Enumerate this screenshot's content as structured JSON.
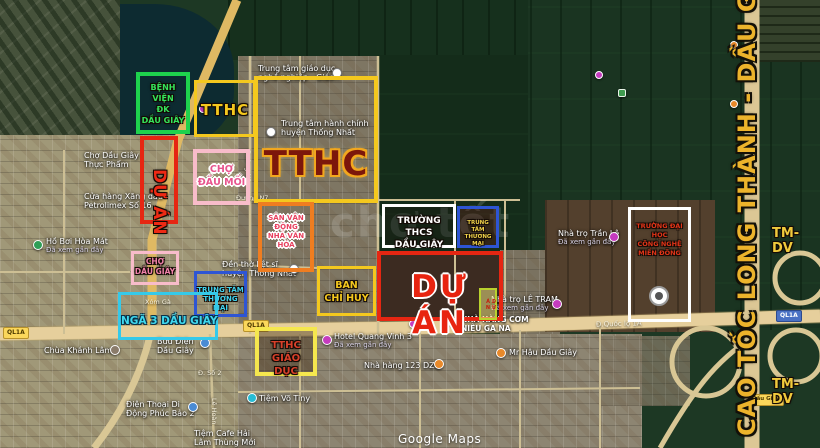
{
  "map": {
    "watermark": "chợ tốt",
    "attribution": "Google Maps"
  },
  "colors": {
    "yellow_box": "#f4c81e",
    "red_box": "#e62612",
    "green_box": "#1ed24d",
    "pink_box": "#f8bcca",
    "blue_box": "#2e55d4",
    "cyan_box": "#35c9e9",
    "orange_box": "#ef7d20",
    "white_box": "#ffffff",
    "lime_box": "#cde23e",
    "gold_text": "#ecb32b"
  },
  "annotations": {
    "benh_vien": {
      "line1": "BỆNH VIỆN",
      "line2": "ĐK",
      "line3": "DẦU GIÂY"
    },
    "tthc_small": {
      "label": "TTHC"
    },
    "tthc_big": {
      "label": "TTHC"
    },
    "du_an_left": {
      "label": "DỰ ÁN"
    },
    "cho_dau_moi": {
      "line1": "CHỢ",
      "line2": "ĐẦU MỐI"
    },
    "san_van_dong": {
      "line1": "SÂN VẬN ĐỘNG",
      "line2": "NHÀ VĂN HÓA"
    },
    "truong_thcs": {
      "line1": "TRƯỜNG THCS",
      "line2": "DẦU GIÂY"
    },
    "ttm_right": {
      "line1": "TRUNG TÂM",
      "line2": "THƯƠNG MẠI"
    },
    "du_an_big": {
      "label": "DỰ ÁN"
    },
    "ban_chi_huy": {
      "line1": "BAN",
      "line2": "CHỈ HUY"
    },
    "du_an_mini": {
      "label": "DỰ ÁN"
    },
    "cho_dau_giay": {
      "line1": "CHỢ",
      "line2": "DẦU GIÂY"
    },
    "ttm_left": {
      "line1": "TRUNG TÂM",
      "line2": "THƯƠNG MẠI"
    },
    "nga_3": {
      "label": "NGÃ 3 DẦU GIÂY"
    },
    "tthc_giao_duc": {
      "line1": "TTHC",
      "line2": "GIÁO DỤC"
    },
    "truong_dai_hoc": {
      "line1": "TRƯỜNG ĐẠI HỌC",
      "line2": "CÔNG NGHỆ",
      "line3": "MIỀN ĐÔNG"
    },
    "cao_toc": {
      "label": "CAO TỐC LONG THÀNH - DẦU GIÂY"
    },
    "tm_dv": {
      "label": "TM-DV"
    }
  },
  "road_labels": {
    "ql1a": "QL1A",
    "quoc_lo_1a": "Đ.Quốc lộ 1A",
    "duong_n7": "Đường N7",
    "duong_n1": "Đường N1",
    "d_so_2": "Đ. Số 2",
    "le_hoan": "Lê Hoàn",
    "xom_ga": "Xóm Gà",
    "dau_giay": "Dầu Giây"
  },
  "pois": {
    "trung_tam_giao_duc": {
      "line1": "Trung tâm giáo dục",
      "line2": "nghề nghiệp - Giáo..."
    },
    "trung_tam_hanh_chinh": {
      "line1": "Trung tâm hành chính",
      "line2": "huyện Thống Nhất"
    },
    "cho_thuc_pham": {
      "line1": "Chợ Dầu Giây",
      "line2": "Thực Phẩm"
    },
    "petrolimex": {
      "line1": "Cửa hàng Xăng dầu",
      "line2": "Petrolimex Số 16"
    },
    "den_liet_si": {
      "line1": "Đền thờ liệt sĩ",
      "line2": "huyện Thống Nhất"
    },
    "ho_boi": {
      "name": "Hồ Bơi Hòa Mát",
      "sub": "Đã xem gần đây"
    },
    "chua_khanh_lam": {
      "name": "Chùa Khánh Lâm"
    },
    "buu_dien": {
      "line1": "Bưu Điện",
      "line2": "Dầu Giây"
    },
    "dien_thoai": {
      "line1": "Điện Thoại Di",
      "line2": "Động Phúc Bảo 2"
    },
    "tiem_cafe": {
      "line1": "Tiệm Cafe Hải",
      "line2": "Lâm Thùng Mới"
    },
    "hotel_quang_vinh": {
      "name": "Hotel Quang Vinh 3",
      "sub": "Đã xem gần đây"
    },
    "nha_hang_123": {
      "name": "Nhà hàng 123 DZÔ"
    },
    "tiem_vo": {
      "name": "Tiệm Võ Tiny"
    },
    "mr_hau": {
      "name": "Mr Hậu Dầu Giây"
    },
    "com_nieu": {
      "line1": "NHÀ HÀNG CƠM",
      "line2": "NIÊU GA NA"
    },
    "nha_tro_le_tram": {
      "name": "Nhà trọ LÊ TRAM",
      "sub": "Đã xem gần đây"
    },
    "nha_tro_tran_le": {
      "name": "Nhà trọ Trần Lê",
      "sub": "Đã xem gần đây"
    }
  }
}
